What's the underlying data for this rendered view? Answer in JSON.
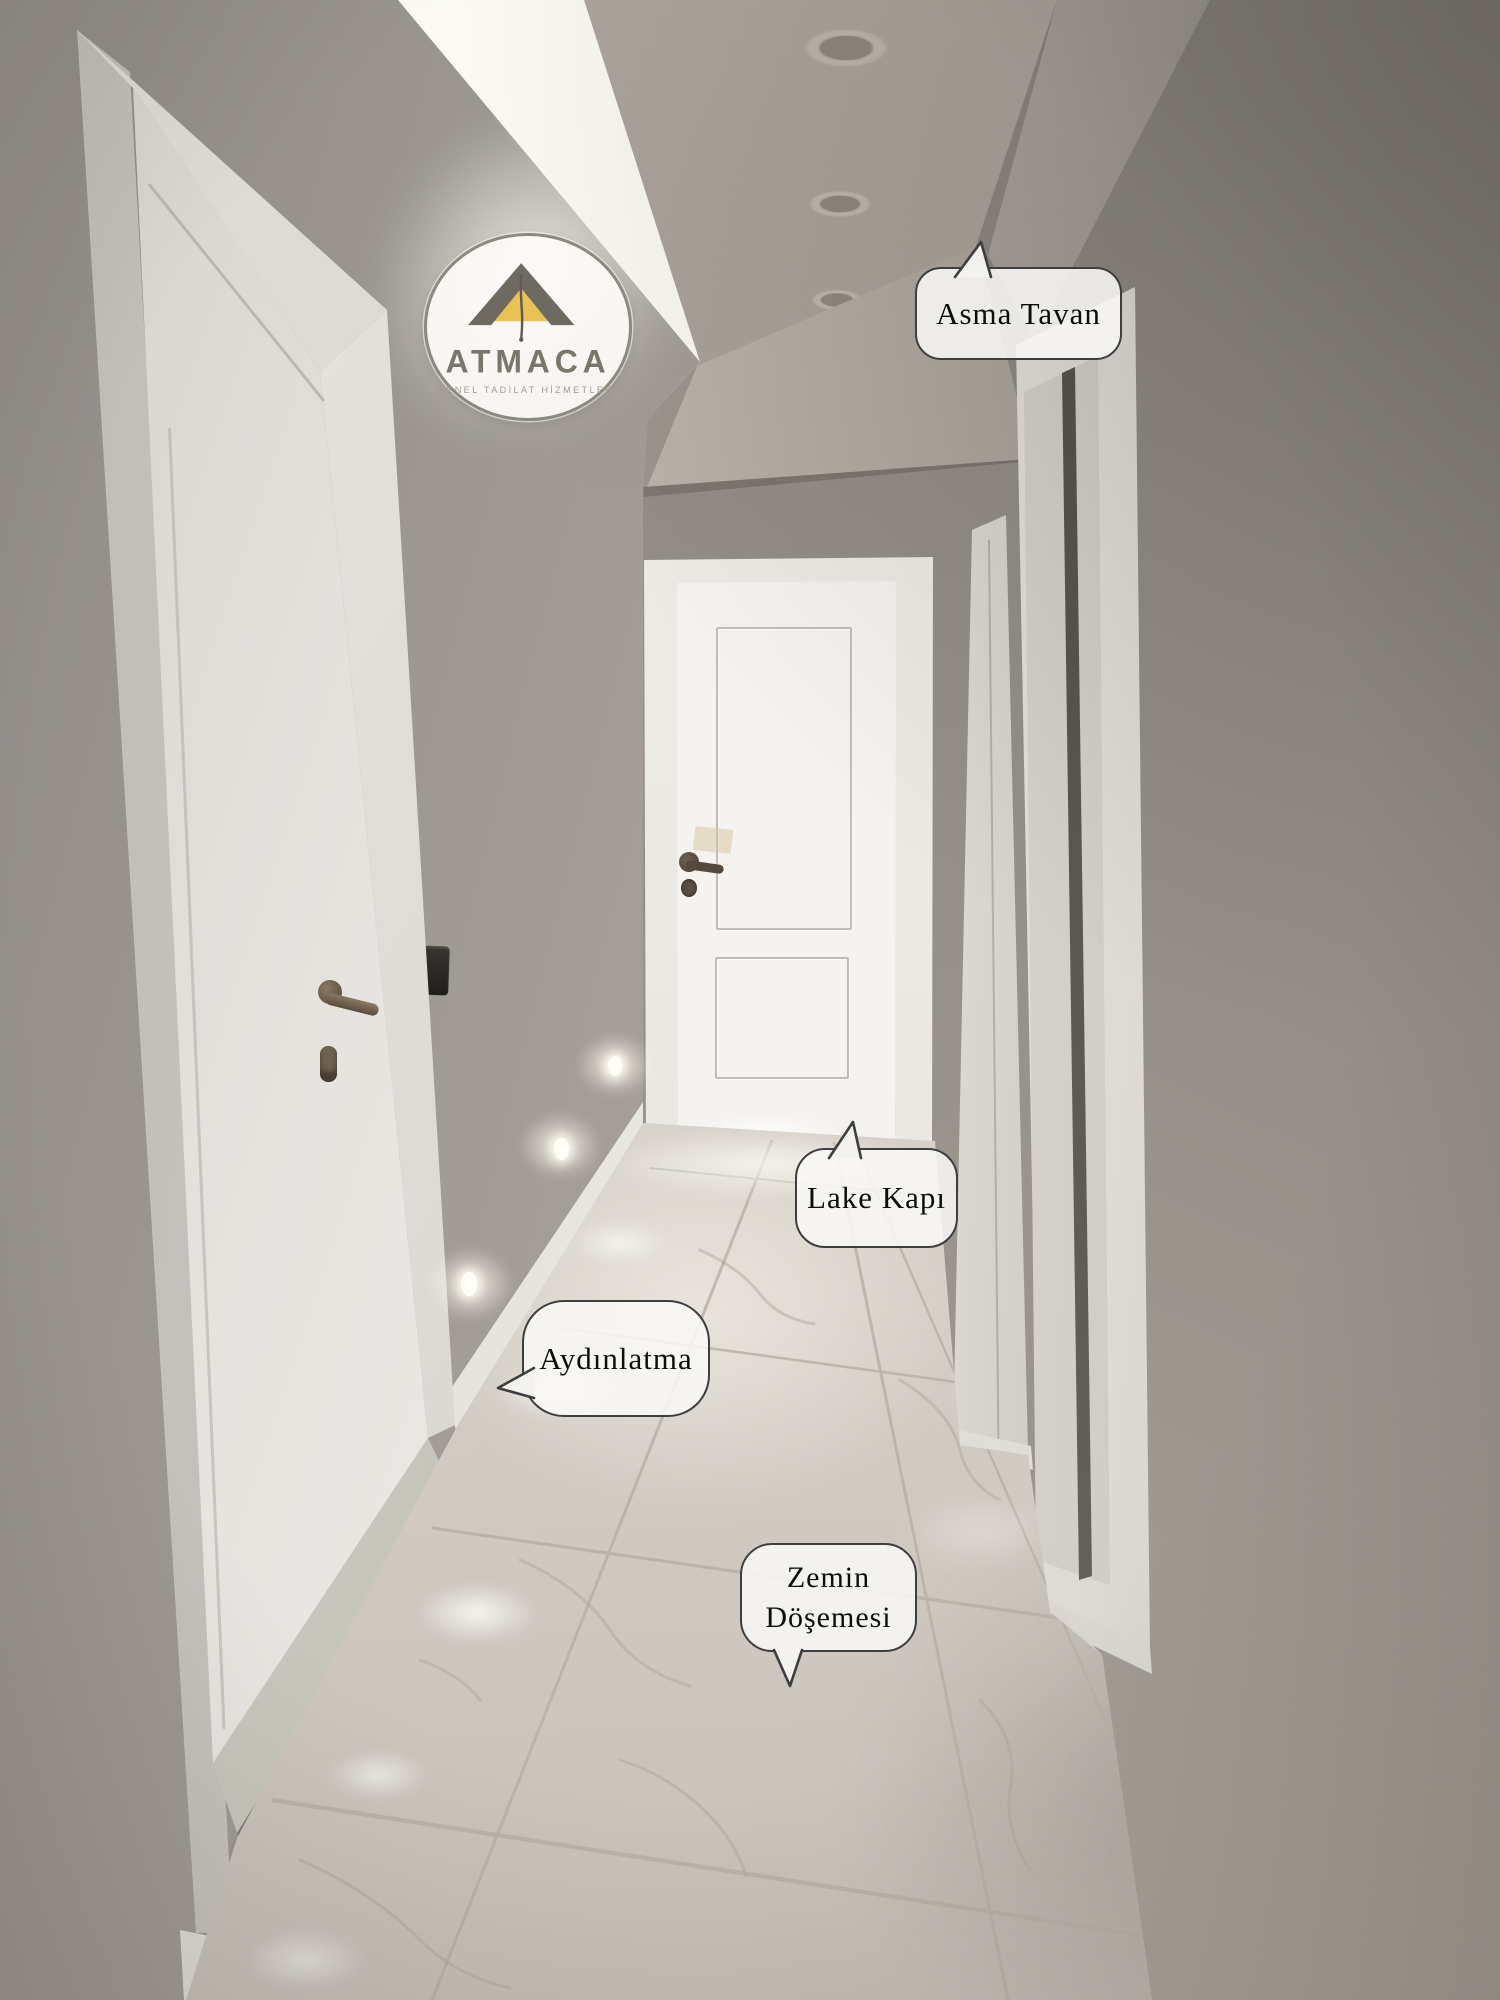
{
  "logo": {
    "brand": "ATMACA",
    "tagline": "GENEL TADİLAT HİZMETLERİ"
  },
  "annotations": {
    "asma_tavan": {
      "label": "Asma Tavan"
    },
    "lake_kapi": {
      "label": "Lake Kapı"
    },
    "aydinlatma": {
      "label": "Aydınlatma"
    },
    "zemin": {
      "label_line1": "Zemin",
      "label_line2": "Döşemesi"
    }
  },
  "colors": {
    "label_border": "#3e3e3e",
    "label_background": "#faf9f6",
    "brand_text": "#7b766c",
    "brand_gold": "#e9c155",
    "wall_gray": "#9a948d",
    "floor_white": "#e7e2da"
  }
}
